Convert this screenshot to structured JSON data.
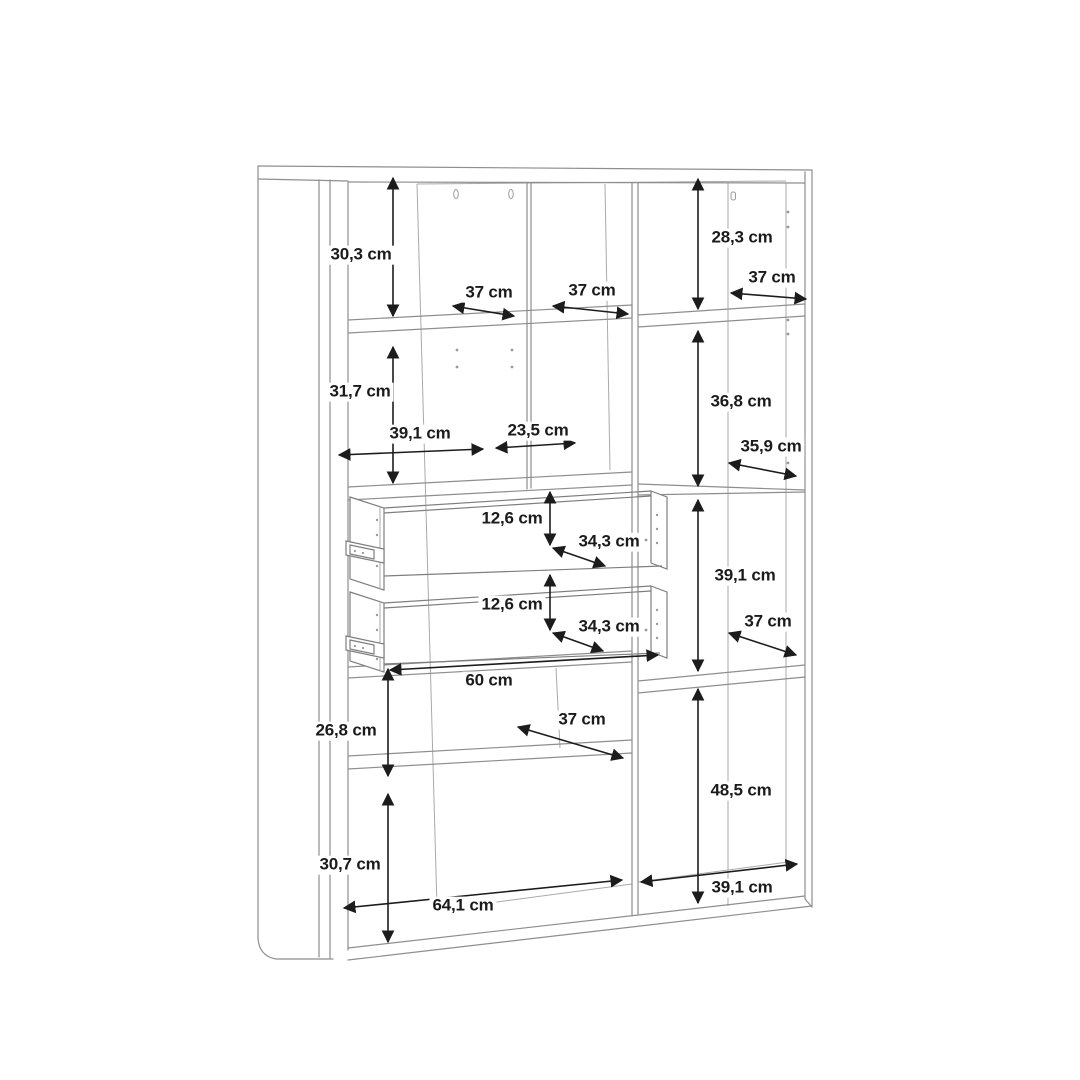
{
  "image": {
    "background": "#ffffff",
    "description": "Technical dimension line drawing of a highboard storage cabinet with open shelf compartments and two pull-out drawers, viewed in slight perspective, annotated with black double-headed measurement arrows"
  },
  "drawing": {
    "unit": "cm",
    "structure_line_color": "#8e8e8e",
    "dimension_arrow_color": "#1c1c1c",
    "label_text_color": "#1b1b1b"
  },
  "dimensions": [
    {
      "id": "top-left-compartment-height",
      "label": "30,3 cm",
      "value": 30.3,
      "orientation": "vertical"
    },
    {
      "id": "top-right-compartment-height",
      "label": "28,3 cm",
      "value": 28.3,
      "orientation": "vertical"
    },
    {
      "id": "left-column-shelf-depth",
      "label": "37 cm",
      "value": 37,
      "orientation": "diagonal"
    },
    {
      "id": "center-column-shelf-depth",
      "label": "37 cm",
      "value": 37,
      "orientation": "diagonal"
    },
    {
      "id": "right-column-top-depth",
      "label": "37 cm",
      "value": 37,
      "orientation": "diagonal"
    },
    {
      "id": "mid-left-compartment-height",
      "label": "31,7 cm",
      "value": 31.7,
      "orientation": "vertical"
    },
    {
      "id": "mid-right-compartment-height",
      "label": "36,8 cm",
      "value": 36.8,
      "orientation": "vertical"
    },
    {
      "id": "left-column-width",
      "label": "39,1 cm",
      "value": 39.1,
      "orientation": "horizontal"
    },
    {
      "id": "center-column-width",
      "label": "23,5 cm",
      "value": 23.5,
      "orientation": "horizontal"
    },
    {
      "id": "right-shelf-depth-upper",
      "label": "35,9 cm",
      "value": 35.9,
      "orientation": "diagonal"
    },
    {
      "id": "drawer-1-inner-height",
      "label": "12,6 cm",
      "value": 12.6,
      "orientation": "vertical"
    },
    {
      "id": "drawer-1-depth",
      "label": "34,3 cm",
      "value": 34.3,
      "orientation": "diagonal"
    },
    {
      "id": "drawer-2-inner-height",
      "label": "12,6 cm",
      "value": 12.6,
      "orientation": "vertical"
    },
    {
      "id": "drawer-2-depth",
      "label": "34,3 cm",
      "value": 34.3,
      "orientation": "diagonal"
    },
    {
      "id": "right-mid-compartment-height",
      "label": "39,1 cm",
      "value": 39.1,
      "orientation": "vertical"
    },
    {
      "id": "right-shelf-depth-mid",
      "label": "37 cm",
      "value": 37,
      "orientation": "diagonal"
    },
    {
      "id": "drawer-opening-width",
      "label": "60 cm",
      "value": 60,
      "orientation": "horizontal"
    },
    {
      "id": "lower-left-compartment-height",
      "label": "26,8 cm",
      "value": 26.8,
      "orientation": "vertical"
    },
    {
      "id": "lower-shelf-depth",
      "label": "37 cm",
      "value": 37,
      "orientation": "diagonal"
    },
    {
      "id": "right-lower-compartment-height",
      "label": "48,5 cm",
      "value": 48.5,
      "orientation": "vertical"
    },
    {
      "id": "bottom-left-compartment-height",
      "label": "30,7 cm",
      "value": 30.7,
      "orientation": "vertical"
    },
    {
      "id": "bottom-compartment-width",
      "label": "64,1 cm",
      "value": 64.1,
      "orientation": "horizontal"
    },
    {
      "id": "bottom-right-compartment-width",
      "label": "39,1 cm",
      "value": 39.1,
      "orientation": "horizontal"
    }
  ]
}
